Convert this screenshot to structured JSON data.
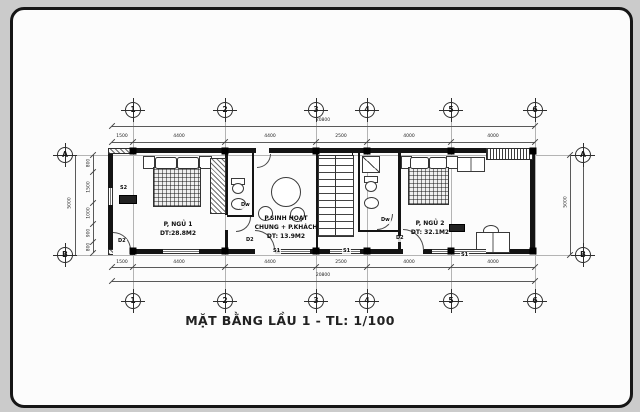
{
  "canvas": {
    "bg": "#cbcbcb",
    "paper": "#fcfcfc",
    "ink": "#1a1a1a"
  },
  "title": "MẶT BẰNG LẦU 1 - TL: 1/100",
  "axes": {
    "top": [
      "1",
      "2",
      "3",
      "4",
      "5",
      "6"
    ],
    "bottom": [
      "1",
      "2",
      "3",
      "4",
      "5",
      "6"
    ],
    "left": [
      "A",
      "B"
    ],
    "right": [
      "A",
      "B"
    ]
  },
  "dims": {
    "top_total": "20800",
    "bottom_total": "20800",
    "top": [
      "1500",
      "4400",
      "4400",
      "2500",
      "4000",
      "4000"
    ],
    "bottom": [
      "1500",
      "4400",
      "4400",
      "2500",
      "4000",
      "4000"
    ],
    "left_total": "5000",
    "right_total": "5000",
    "left": [
      "800",
      "1500",
      "1000",
      "900",
      "800"
    ]
  },
  "rooms": {
    "bedroom1": {
      "name": "P, NGỦ 1",
      "area": "DT:28.8M2"
    },
    "living": {
      "name": "P.SINH HOẠT",
      "name2": "CHUNG + P.KHÁCH",
      "area": "DT: 13.9M2"
    },
    "bedroom2": {
      "name": "P, NGỦ 2",
      "area": "DT: 32.1M2"
    }
  },
  "tags": {
    "window_left": "S2",
    "door_bed1": "D2",
    "door_bath1": "Dw",
    "door_living": "D2",
    "window_living": "S1",
    "window_stair": "S1",
    "door_bath2": "Dw",
    "door_bed2": "D2",
    "window_bed2": "S1"
  }
}
